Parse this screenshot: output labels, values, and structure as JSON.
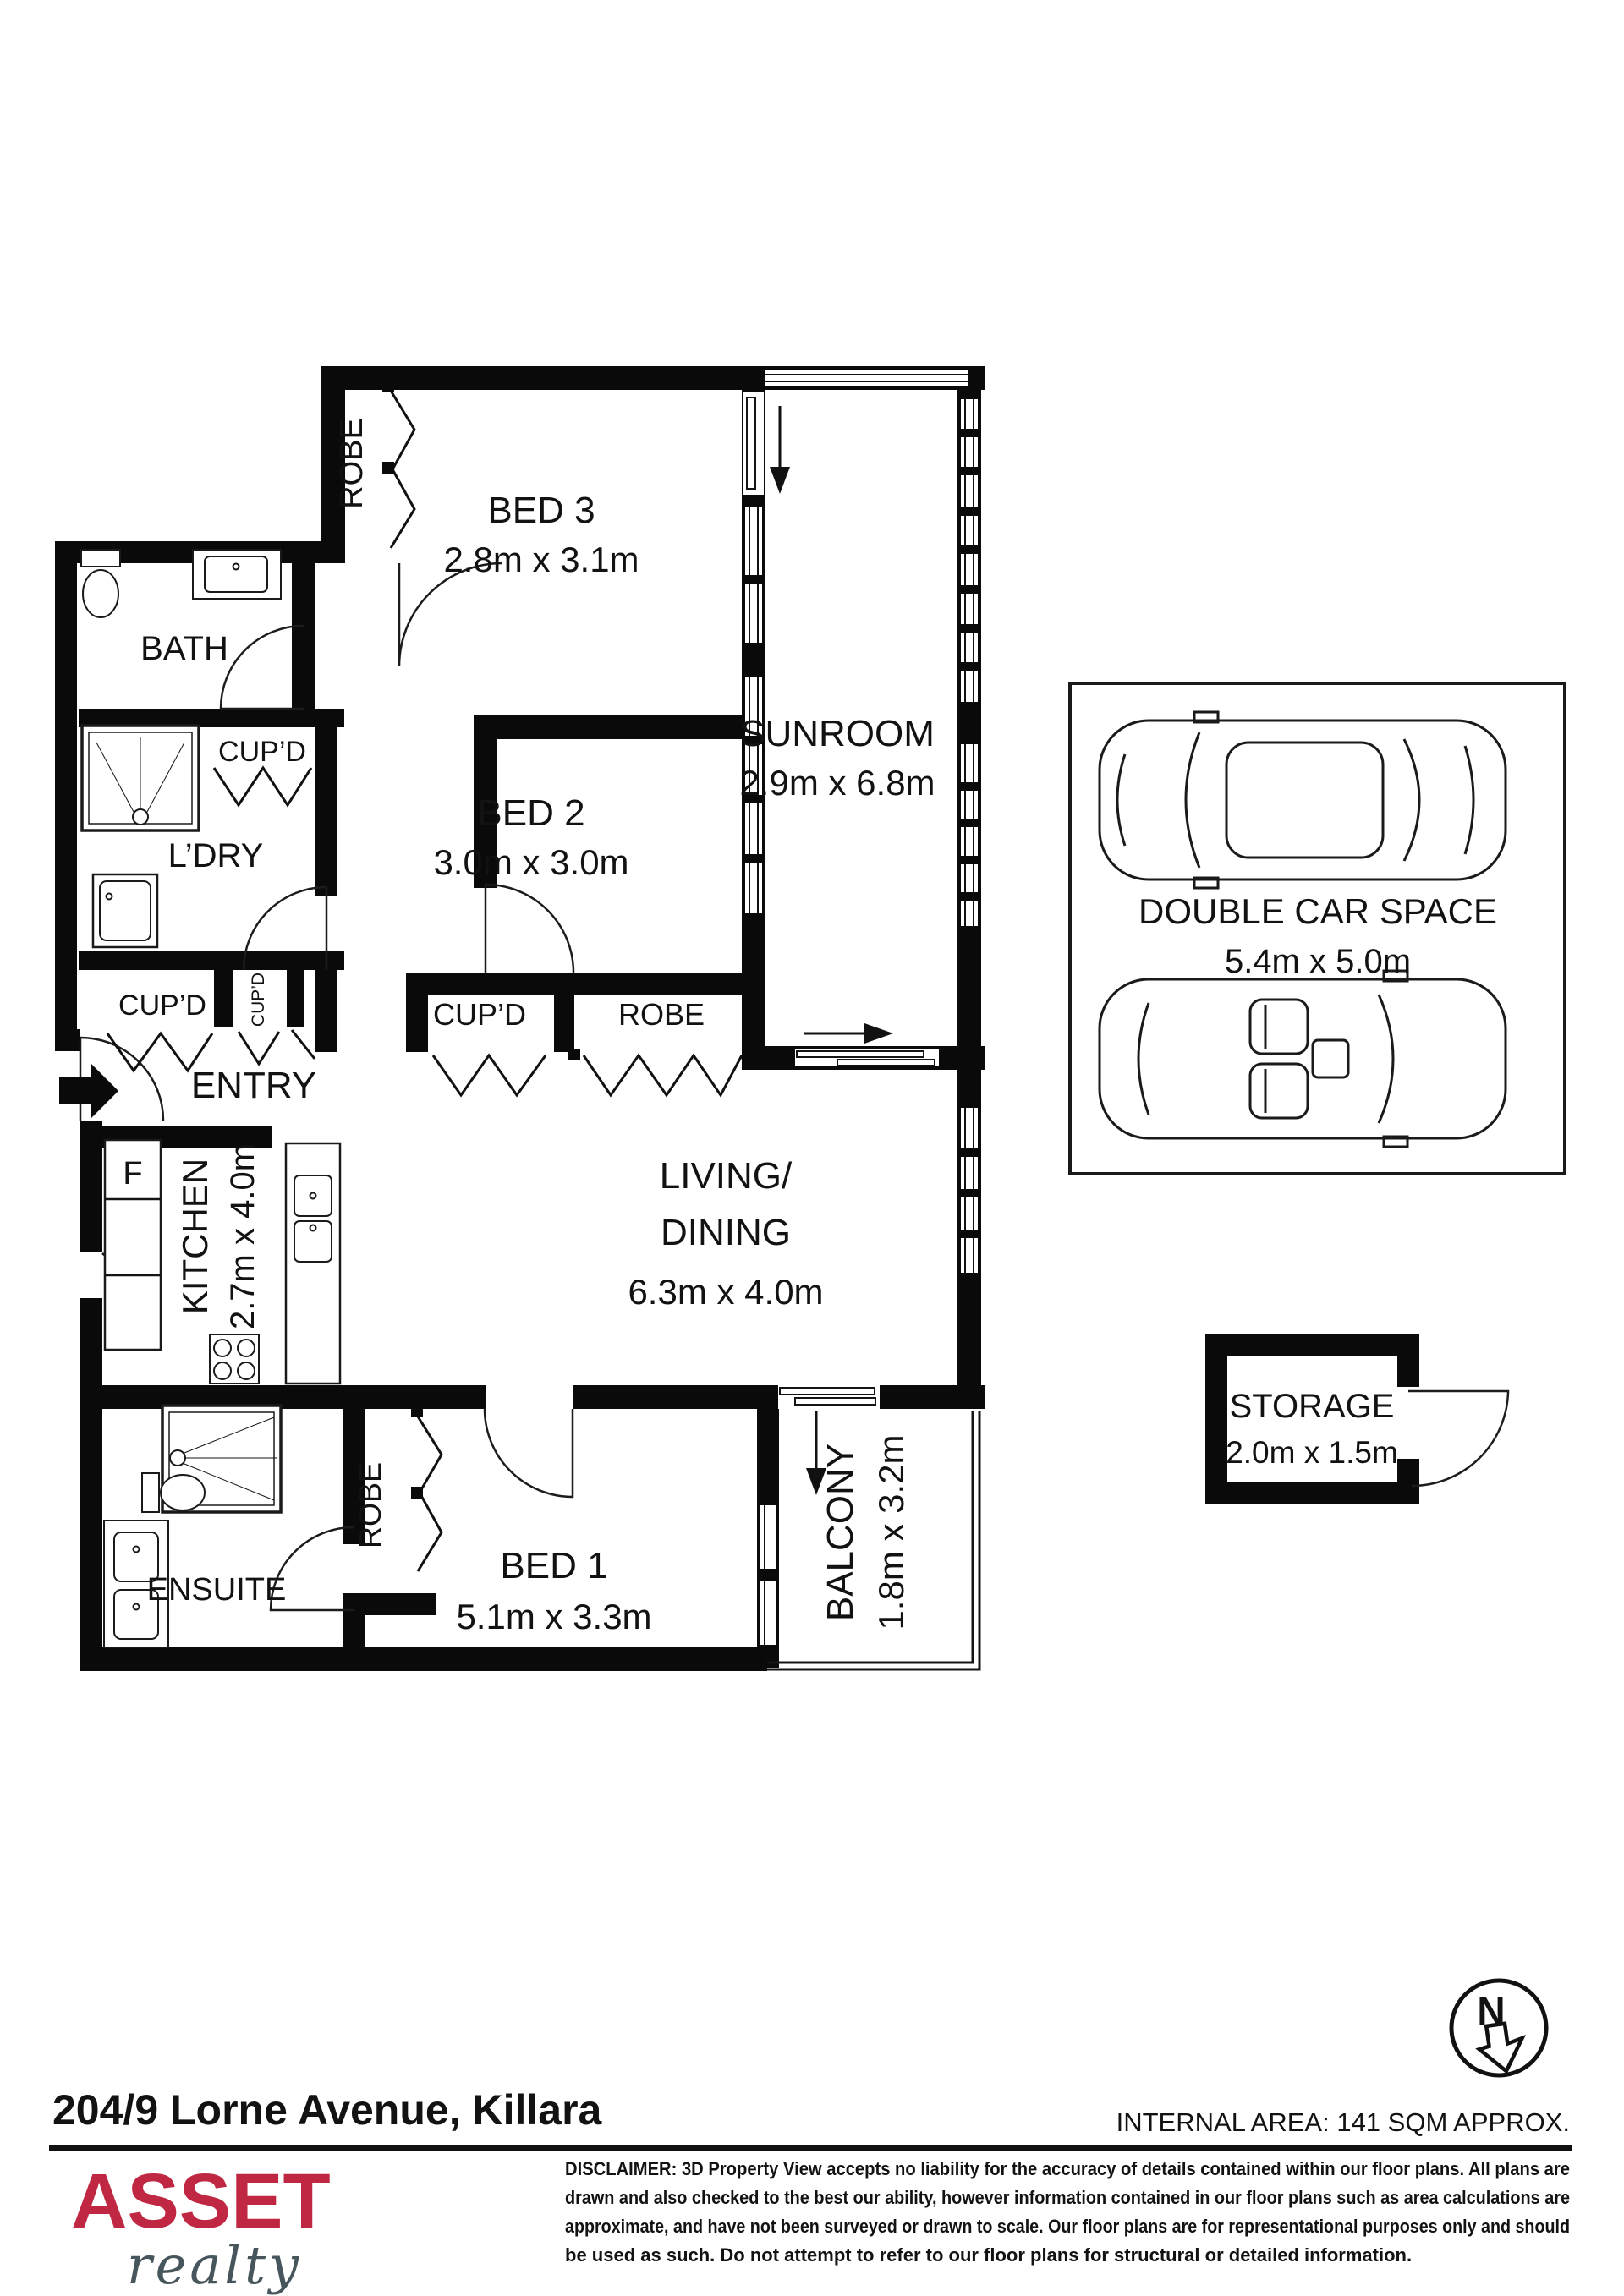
{
  "header": {
    "address": "204/9 Lorne Avenue, Killara",
    "internal_area": "INTERNAL AREA: 141 SQM APPROX."
  },
  "plan": {
    "rooms": {
      "bed3": {
        "name": "BED 3",
        "dims": "2.8m x 3.1m"
      },
      "bed2": {
        "name": "BED 2",
        "dims": "3.0m x 3.0m"
      },
      "bed1": {
        "name": "BED 1",
        "dims": "5.1m x 3.3m"
      },
      "sunroom": {
        "name": "SUNROOM",
        "dims": "2.9m x 6.8m"
      },
      "living": {
        "line1": "LIVING/",
        "line2": "DINING",
        "dims": "6.3m x 4.0m"
      },
      "kitchen": {
        "name": "KITCHEN",
        "dims": "2.7m x 4.0m"
      },
      "bath": {
        "name": "BATH"
      },
      "ldry": {
        "name": "L’DRY"
      },
      "entry": {
        "name": "ENTRY"
      },
      "ensuite": {
        "name": "ENSUITE"
      },
      "balcony": {
        "name": "BALCONY",
        "dims": "1.8m x 3.2m"
      },
      "storage": {
        "name": "STORAGE",
        "dims": "2.0m x 1.5m"
      },
      "car_space": {
        "name": "DOUBLE CAR  SPACE",
        "dims": "5.4m x 5.0m"
      }
    },
    "labels": {
      "robe": "ROBE",
      "cupd": "CUP’D",
      "fridge": "F",
      "north": "N"
    }
  },
  "footer": {
    "logo_primary": "ASSET",
    "logo_secondary": "realty",
    "disclaimer_lines": {
      "0": "DISCLAIMER: 3D Property View accepts no liability for the accuracy of details contained within our floor plans. All plans are",
      "1": "drawn and also checked to the best our ability, however information contained in our floor plans such as area calculations are",
      "2": "approximate, and have not been surveyed or drawn to scale. Our floor plans are for representational purposes only and should",
      "3": "be used as such. Do not attempt to refer to our floor plans for structural or detailed information."
    }
  }
}
